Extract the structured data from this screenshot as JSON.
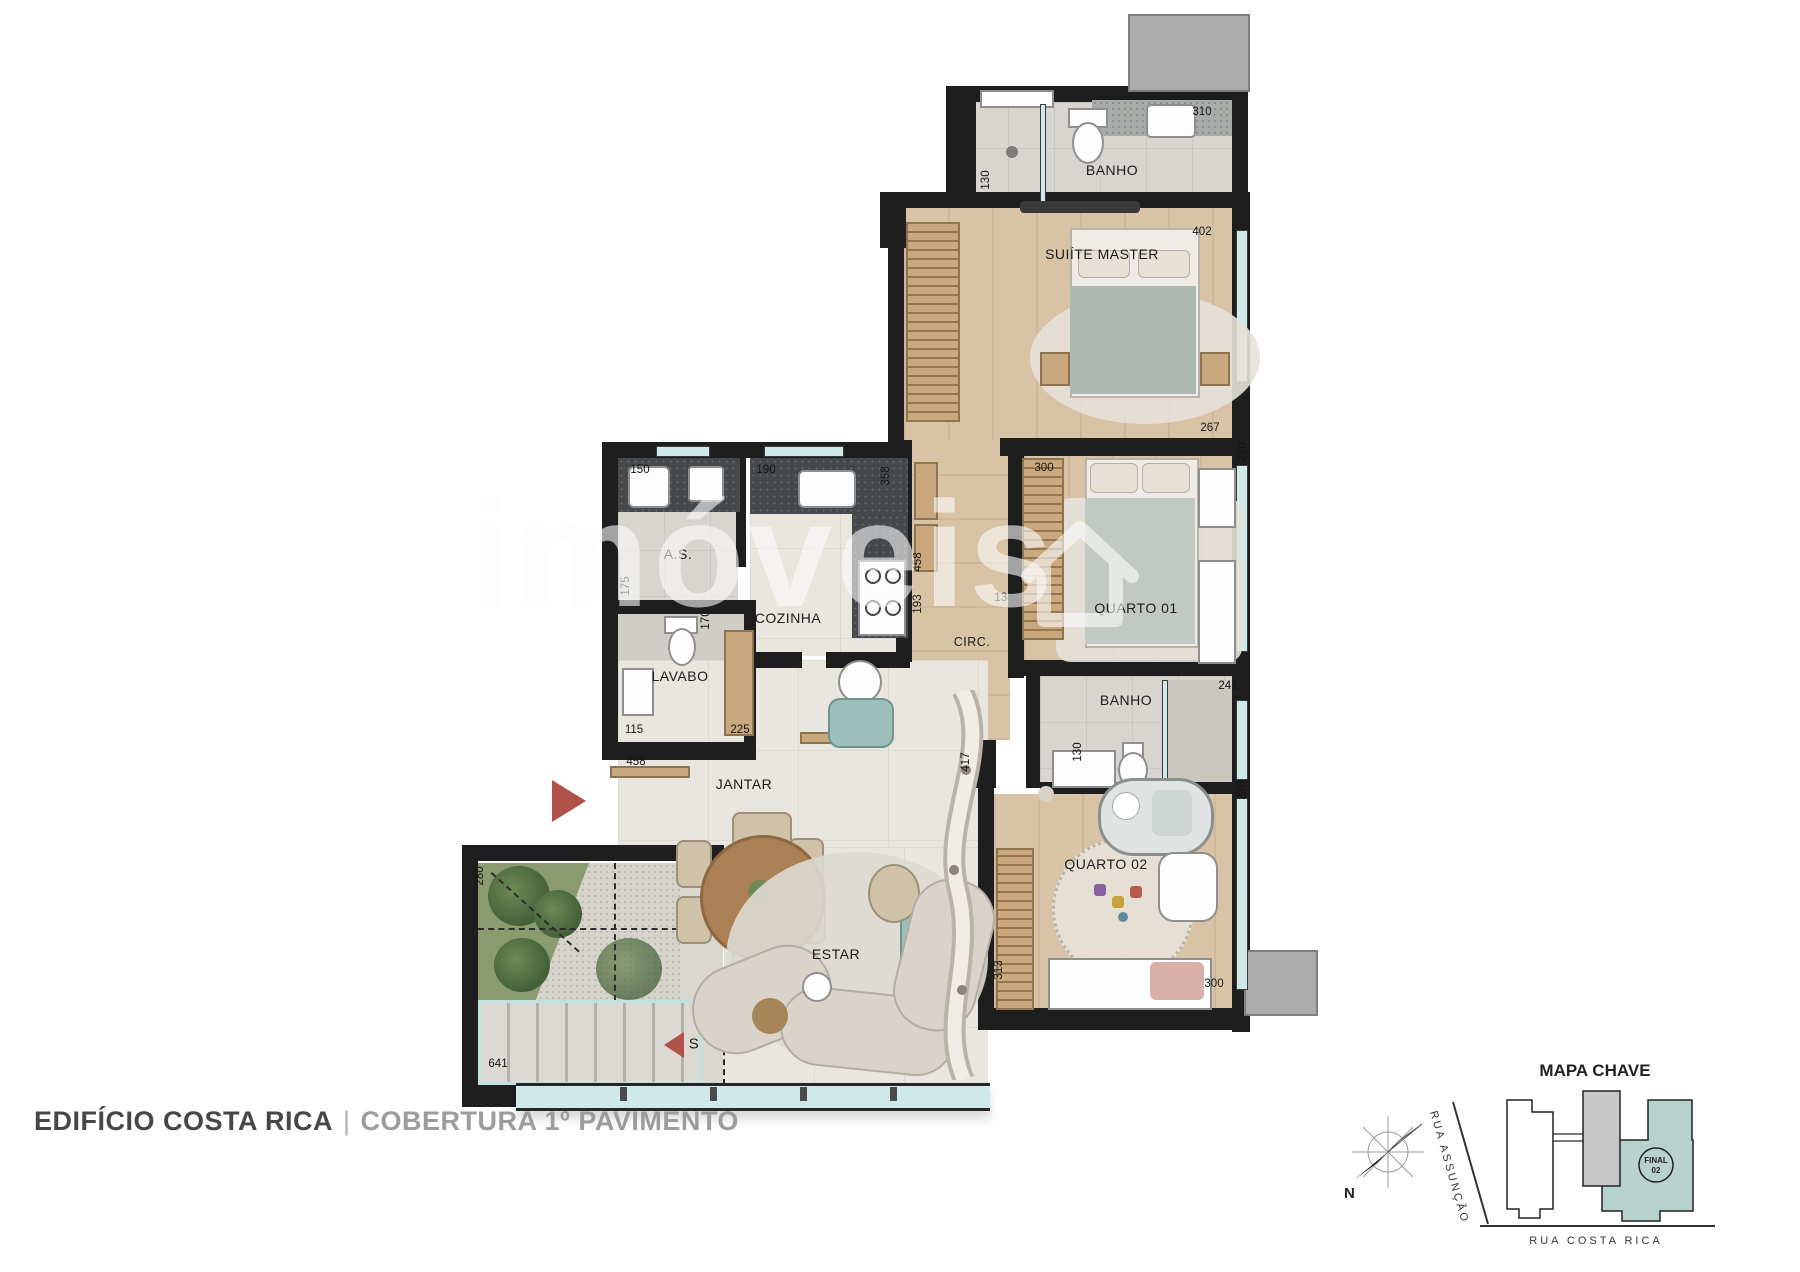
{
  "title": {
    "building": "EDIFÍCIO COSTA RICA",
    "separator": "|",
    "floor": "COBERTURA 1º PAVIMENTO"
  },
  "watermark": {
    "text": "imóveis"
  },
  "plan": {
    "rooms": {
      "banho_suite": "BANHO",
      "suite": "SUIÍTE MASTER",
      "quarto1": "QUARTO 01",
      "circ": "CIRC.",
      "banho2": "BANHO",
      "quarto2": "QUARTO 02",
      "as": "A.S.",
      "cozinha": "COZINHA",
      "lavabo": "LAVABO",
      "jantar": "JANTAR",
      "estar": "ESTAR"
    },
    "dims": {
      "banho_top_310": "310",
      "banho_top_130": "130",
      "suite_402": "402",
      "suite_267": "267",
      "q1_300": "300",
      "q1_270": "270",
      "as_150": "150",
      "coz_190": "190",
      "coz_358": "358",
      "as_175": "175",
      "lav_170": "170",
      "lav_115": "115",
      "lav_225": "225",
      "jantar_458": "458",
      "circ_458": "458",
      "circ_193": "193",
      "circ_134": "134",
      "banho2_241": "241",
      "banho2_130": "130",
      "q2_270": "270",
      "estar_417": "417",
      "q2_313": "313",
      "q2_300": "300",
      "terr_280": "280",
      "terr_641": "641"
    },
    "stair_label": "S"
  },
  "mapa_chave": {
    "title": "MAPA CHAVE",
    "compass_north": "N",
    "street_left": "RUA ASSUNÇÃO",
    "street_bottom": "RUA COSTA RICA",
    "unit_badge_line1": "FINAL",
    "unit_badge_line2": "02"
  },
  "colors": {
    "wall": "#1e1e1e",
    "wood": "#d9c3a6",
    "glass": "#cfe9e8",
    "accent_arrow": "#b0524a",
    "keymap_unit": "#b7d2cc",
    "keymap_core": "#c6c6c6"
  }
}
